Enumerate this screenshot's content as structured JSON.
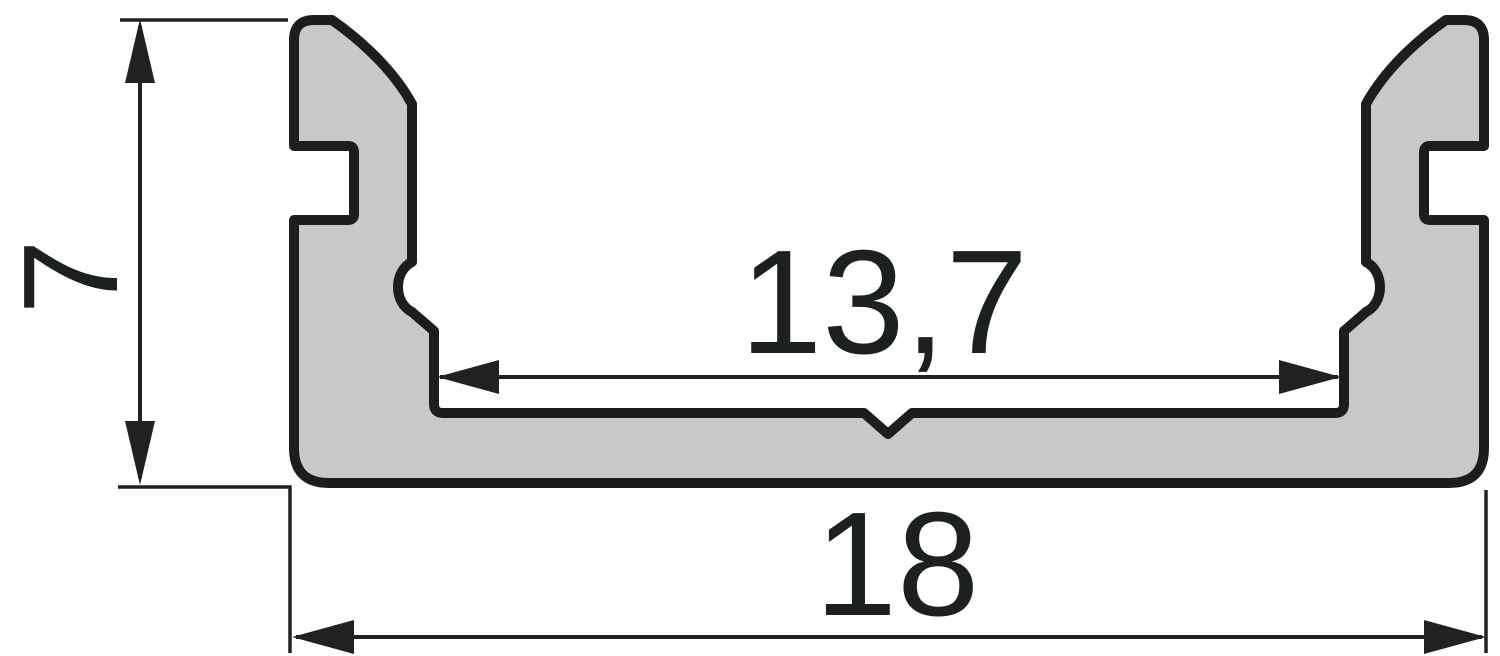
{
  "drawing": {
    "dimensions": {
      "height_label": "7",
      "inner_width_label": "13,7",
      "outer_width_label": "18"
    },
    "colors": {
      "background": "#ffffff",
      "profile_fill": "#c7c8ca",
      "profile_outline": "#1d1d1f",
      "dimension_color": "#1f2122"
    }
  }
}
